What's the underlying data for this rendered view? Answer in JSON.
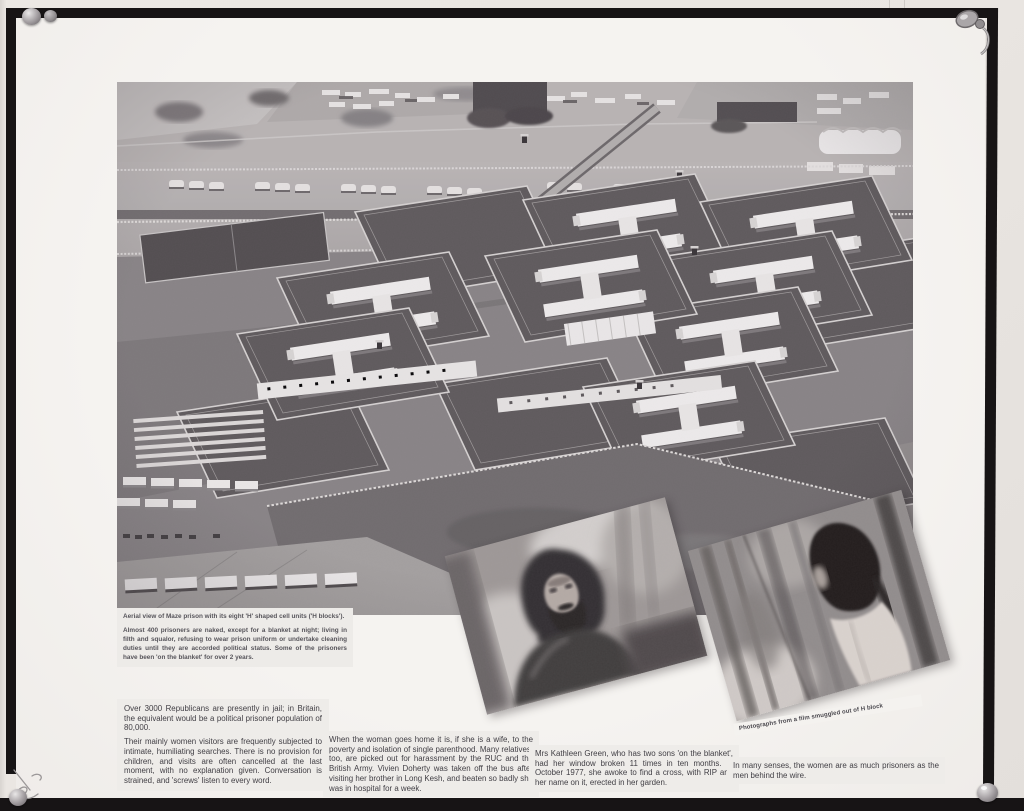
{
  "captions": {
    "aerial": {
      "title": "Aerial view of Maze prison with its eight 'H' shaped cell units ('H blocks').",
      "note": "Almost 400 prisoners are naked, except for a blanket at night; living in filth and squalor, refusing to wear prison uniform or undertake cleaning duties until they are accorded political status. Some of the prisoners have been 'on the blanket' for over 2 years."
    },
    "smuggled_photos": "Photographs from a film smuggled out of H block"
  },
  "text_blocks": {
    "jail_population": {
      "p1": "Over 3000 Republicans are presently in jail; in Britain, the equivalent would be a political prisoner population of 80,000.",
      "p2": "Their mainly women visitors are frequently subjected to intimate, humiliating searches. There is no provision for children, and visits are often cancelled at the last moment, with no explanation given. Conversation is strained, and 'screws' listen to every word."
    },
    "going_home": "When the woman goes home it is, if she is a wife, to the poverty and isolation of single parenthood. Many relatives, too, are picked out for harassment by the RUC and the British Army. Vivien Doherty was taken off the bus after visiting her brother in Long Kesh, and beaten so badly she was in hospital for a week.",
    "kathleen_green": "Mrs Kathleen Green, who has two sons 'on the blanket', had her window broken 11 times in ten months. In October 1977, she awoke to find a cross, with RIP and her name on it, erected in her garden.",
    "women_prisoners": "In many senses, the women are as much prisoners as the men behind the wire."
  },
  "colors": {
    "frame": "#171415",
    "panel": "#f3f1ee",
    "wall": "#e9e5e1",
    "caption_text": "#57555b",
    "body_text": "#403e44"
  }
}
